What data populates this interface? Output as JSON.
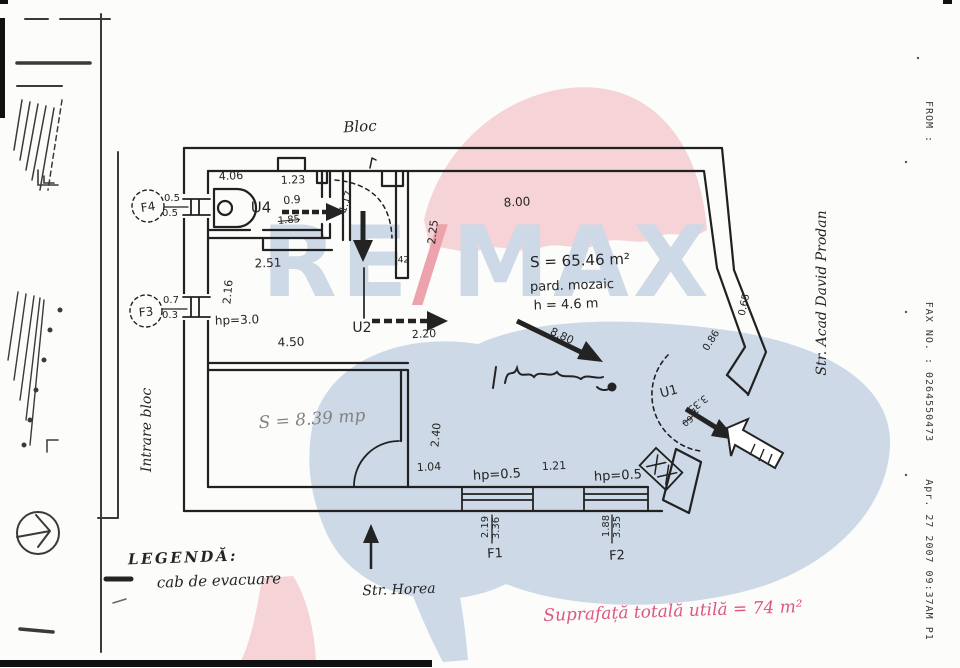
{
  "colors": {
    "paper": "#fcfcfa",
    "ink": "#242424",
    "note_pink": "#dd5680",
    "watermark_pink": "#f5d3d7",
    "watermark_blue": "#cdd9e7",
    "watermark_slash": "#eca3ad"
  },
  "watermark": {
    "re": "RE",
    "slash": "/",
    "max": "MAX"
  },
  "fax_header": {
    "from_label": "FROM :",
    "fax_no": "FAX NO. : 0264550473",
    "timestamp": "Apr. 27 2007 09:37AM P1"
  },
  "labels": {
    "streets": [
      {
        "name": "block-label",
        "text": "Bloc",
        "x": 360,
        "y": 127,
        "rot": -3,
        "size": 15,
        "cls": "cur"
      },
      {
        "name": "entrance-label",
        "text": "Intrare bloc",
        "x": 147,
        "y": 430,
        "rot": -90,
        "size": 14,
        "cls": "cur"
      },
      {
        "name": "street-right-label",
        "text": "Str. Acad David Prodan",
        "x": 822,
        "y": 293,
        "rot": -90,
        "size": 14,
        "cls": "cur"
      },
      {
        "name": "street-bottom-label",
        "text": "Str. Horea",
        "x": 399,
        "y": 590,
        "rot": -2,
        "size": 14,
        "cls": "cur"
      }
    ],
    "rooms": [
      {
        "name": "door-u4-label",
        "text": "U4",
        "x": 261,
        "y": 208,
        "rot": 0,
        "size": 15
      },
      {
        "name": "door-u2-label",
        "text": "U2",
        "x": 362,
        "y": 328,
        "rot": 0,
        "size": 14
      },
      {
        "name": "door-u1-label",
        "text": "U1",
        "x": 669,
        "y": 392,
        "rot": -15,
        "size": 13
      },
      {
        "name": "window-f1-label",
        "text": "F1",
        "x": 495,
        "y": 554,
        "rot": -3,
        "size": 13
      },
      {
        "name": "window-f2-label",
        "text": "F2",
        "x": 617,
        "y": 556,
        "rot": -3,
        "size": 13
      },
      {
        "name": "window-f3-label",
        "text": "F3",
        "x": 146,
        "y": 312,
        "rot": -5,
        "size": 12
      },
      {
        "name": "window-f4-label",
        "text": "F4",
        "x": 148,
        "y": 207,
        "rot": -8,
        "size": 12
      },
      {
        "name": "main-room-area",
        "text": "S = 65.46 m²",
        "x": 580,
        "y": 261,
        "rot": -2,
        "size": 15
      },
      {
        "name": "main-room-floor",
        "text": "pard. mozaic",
        "x": 572,
        "y": 286,
        "rot": -2,
        "size": 13
      },
      {
        "name": "main-room-height",
        "text": "h = 4.6 m",
        "x": 566,
        "y": 305,
        "rot": -2,
        "size": 13
      },
      {
        "name": "small-room-area",
        "text": "S = 8.39 mp",
        "x": 312,
        "y": 420,
        "rot": -4,
        "size": 17,
        "cls": "cur pencil"
      },
      {
        "name": "total-area-note",
        "text": "Suprafață totală utilă = 74 m²",
        "x": 673,
        "y": 612,
        "rot": -2,
        "size": 17,
        "cls": "cur pink"
      }
    ],
    "legend": [
      {
        "name": "legend-title",
        "text": "LEGENDĂ:",
        "x": 183,
        "y": 558,
        "rot": -2,
        "size": 15,
        "cls": "cur legendt"
      },
      {
        "name": "legend-item-evacuation",
        "text": "cab de evacuare",
        "x": 219,
        "y": 581,
        "rot": -2,
        "size": 15,
        "cls": "cur"
      }
    ],
    "dimensions": [
      {
        "name": "dim-4-06",
        "text": "4.06",
        "x": 231,
        "y": 176,
        "rot": -3,
        "size": 11
      },
      {
        "name": "dim-1-23",
        "text": "1.23",
        "x": 293,
        "y": 180,
        "rot": -2,
        "size": 11
      },
      {
        "name": "dim-f4-top",
        "text": "0.5",
        "x": 172,
        "y": 199,
        "rot": 0,
        "size": 10
      },
      {
        "name": "dim-f4-bottom",
        "text": "0.5",
        "x": 170,
        "y": 214,
        "rot": 0,
        "size": 10
      },
      {
        "name": "dim-0-9",
        "text": "0.9",
        "x": 292,
        "y": 200,
        "rot": -5,
        "size": 11
      },
      {
        "name": "dim-1-85",
        "text": "1.85",
        "x": 289,
        "y": 221,
        "rot": -5,
        "size": 10,
        "cls": "struck"
      },
      {
        "name": "dim-1-17",
        "text": "1.17",
        "x": 347,
        "y": 202,
        "rot": -72,
        "size": 10
      },
      {
        "name": "dim-2-51",
        "text": "2.51",
        "x": 268,
        "y": 263,
        "rot": -2,
        "size": 12
      },
      {
        "name": "dim-2-16",
        "text": "2.16",
        "x": 228,
        "y": 292,
        "rot": -85,
        "size": 11
      },
      {
        "name": "dim-f3-top",
        "text": "0.7",
        "x": 171,
        "y": 301,
        "rot": 0,
        "size": 10
      },
      {
        "name": "dim-f3-bottom",
        "text": "0.3",
        "x": 170,
        "y": 316,
        "rot": 0,
        "size": 10
      },
      {
        "name": "dim-hp-3",
        "text": "hp=3.0",
        "x": 237,
        "y": 320,
        "rot": -2,
        "size": 12
      },
      {
        "name": "dim-4-50",
        "text": "4.50",
        "x": 291,
        "y": 342,
        "rot": -2,
        "size": 12
      },
      {
        "name": "dim-2-25",
        "text": "2.25",
        "x": 433,
        "y": 232,
        "rot": -83,
        "size": 11
      },
      {
        "name": "dim-0-42",
        "text": ".42",
        "x": 402,
        "y": 261,
        "rot": 0,
        "size": 9
      },
      {
        "name": "dim-8-00",
        "text": "8.00",
        "x": 517,
        "y": 202,
        "rot": -3,
        "size": 12
      },
      {
        "name": "dim-2-20",
        "text": "2.20",
        "x": 424,
        "y": 334,
        "rot": -3,
        "size": 11
      },
      {
        "name": "dim-8-80",
        "text": "8.80",
        "x": 562,
        "y": 336,
        "rot": 25,
        "size": 11
      },
      {
        "name": "dim-0-65",
        "text": "0.65",
        "x": 745,
        "y": 305,
        "rot": -78,
        "size": 10
      },
      {
        "name": "dim-0-86",
        "text": "0.86",
        "x": 712,
        "y": 341,
        "rot": -58,
        "size": 10
      },
      {
        "name": "dim-3-35-u1",
        "text": "3.35",
        "x": 697,
        "y": 403,
        "rot": 142,
        "size": 10
      },
      {
        "name": "dim-1-60-u1",
        "text": "1.60",
        "x": 690,
        "y": 417,
        "rot": 142,
        "size": 9,
        "cls": "struck"
      },
      {
        "name": "dim-2-40",
        "text": "2.40",
        "x": 436,
        "y": 435,
        "rot": -85,
        "size": 11
      },
      {
        "name": "dim-1-04",
        "text": "1.04",
        "x": 429,
        "y": 467,
        "rot": -3,
        "size": 11
      },
      {
        "name": "dim-hp-05-left",
        "text": "hp=0.5",
        "x": 497,
        "y": 475,
        "rot": -3,
        "size": 13
      },
      {
        "name": "dim-1-21",
        "text": "1.21",
        "x": 554,
        "y": 466,
        "rot": -3,
        "size": 11
      },
      {
        "name": "dim-hp-05-right",
        "text": "hp=0.5",
        "x": 618,
        "y": 476,
        "rot": -3,
        "size": 13
      },
      {
        "name": "dim-f1-width",
        "text": "2.19",
        "x": 486,
        "y": 527,
        "rot": -90,
        "size": 10
      },
      {
        "name": "dim-f1-height",
        "text": "3.36",
        "x": 497,
        "y": 528,
        "rot": -90,
        "size": 10
      },
      {
        "name": "dim-f2-width",
        "text": "1.88",
        "x": 607,
        "y": 526,
        "rot": -90,
        "size": 10
      },
      {
        "name": "dim-f2-height",
        "text": "3.35",
        "x": 618,
        "y": 527,
        "rot": -90,
        "size": 10
      }
    ],
    "fax": [
      {
        "name": "fax-from",
        "text": "FROM :",
        "x": 928,
        "y": 122,
        "rot": 90,
        "size": 10,
        "cls": "mono"
      },
      {
        "name": "fax-number",
        "text": "FAX NO. : 0264550473",
        "x": 928,
        "y": 372,
        "rot": 90,
        "size": 10,
        "cls": "mono"
      },
      {
        "name": "fax-timestamp",
        "text": "Apr. 27 2007 09:37AM P1",
        "x": 928,
        "y": 560,
        "rot": 90,
        "size": 10,
        "cls": "mono"
      }
    ]
  }
}
